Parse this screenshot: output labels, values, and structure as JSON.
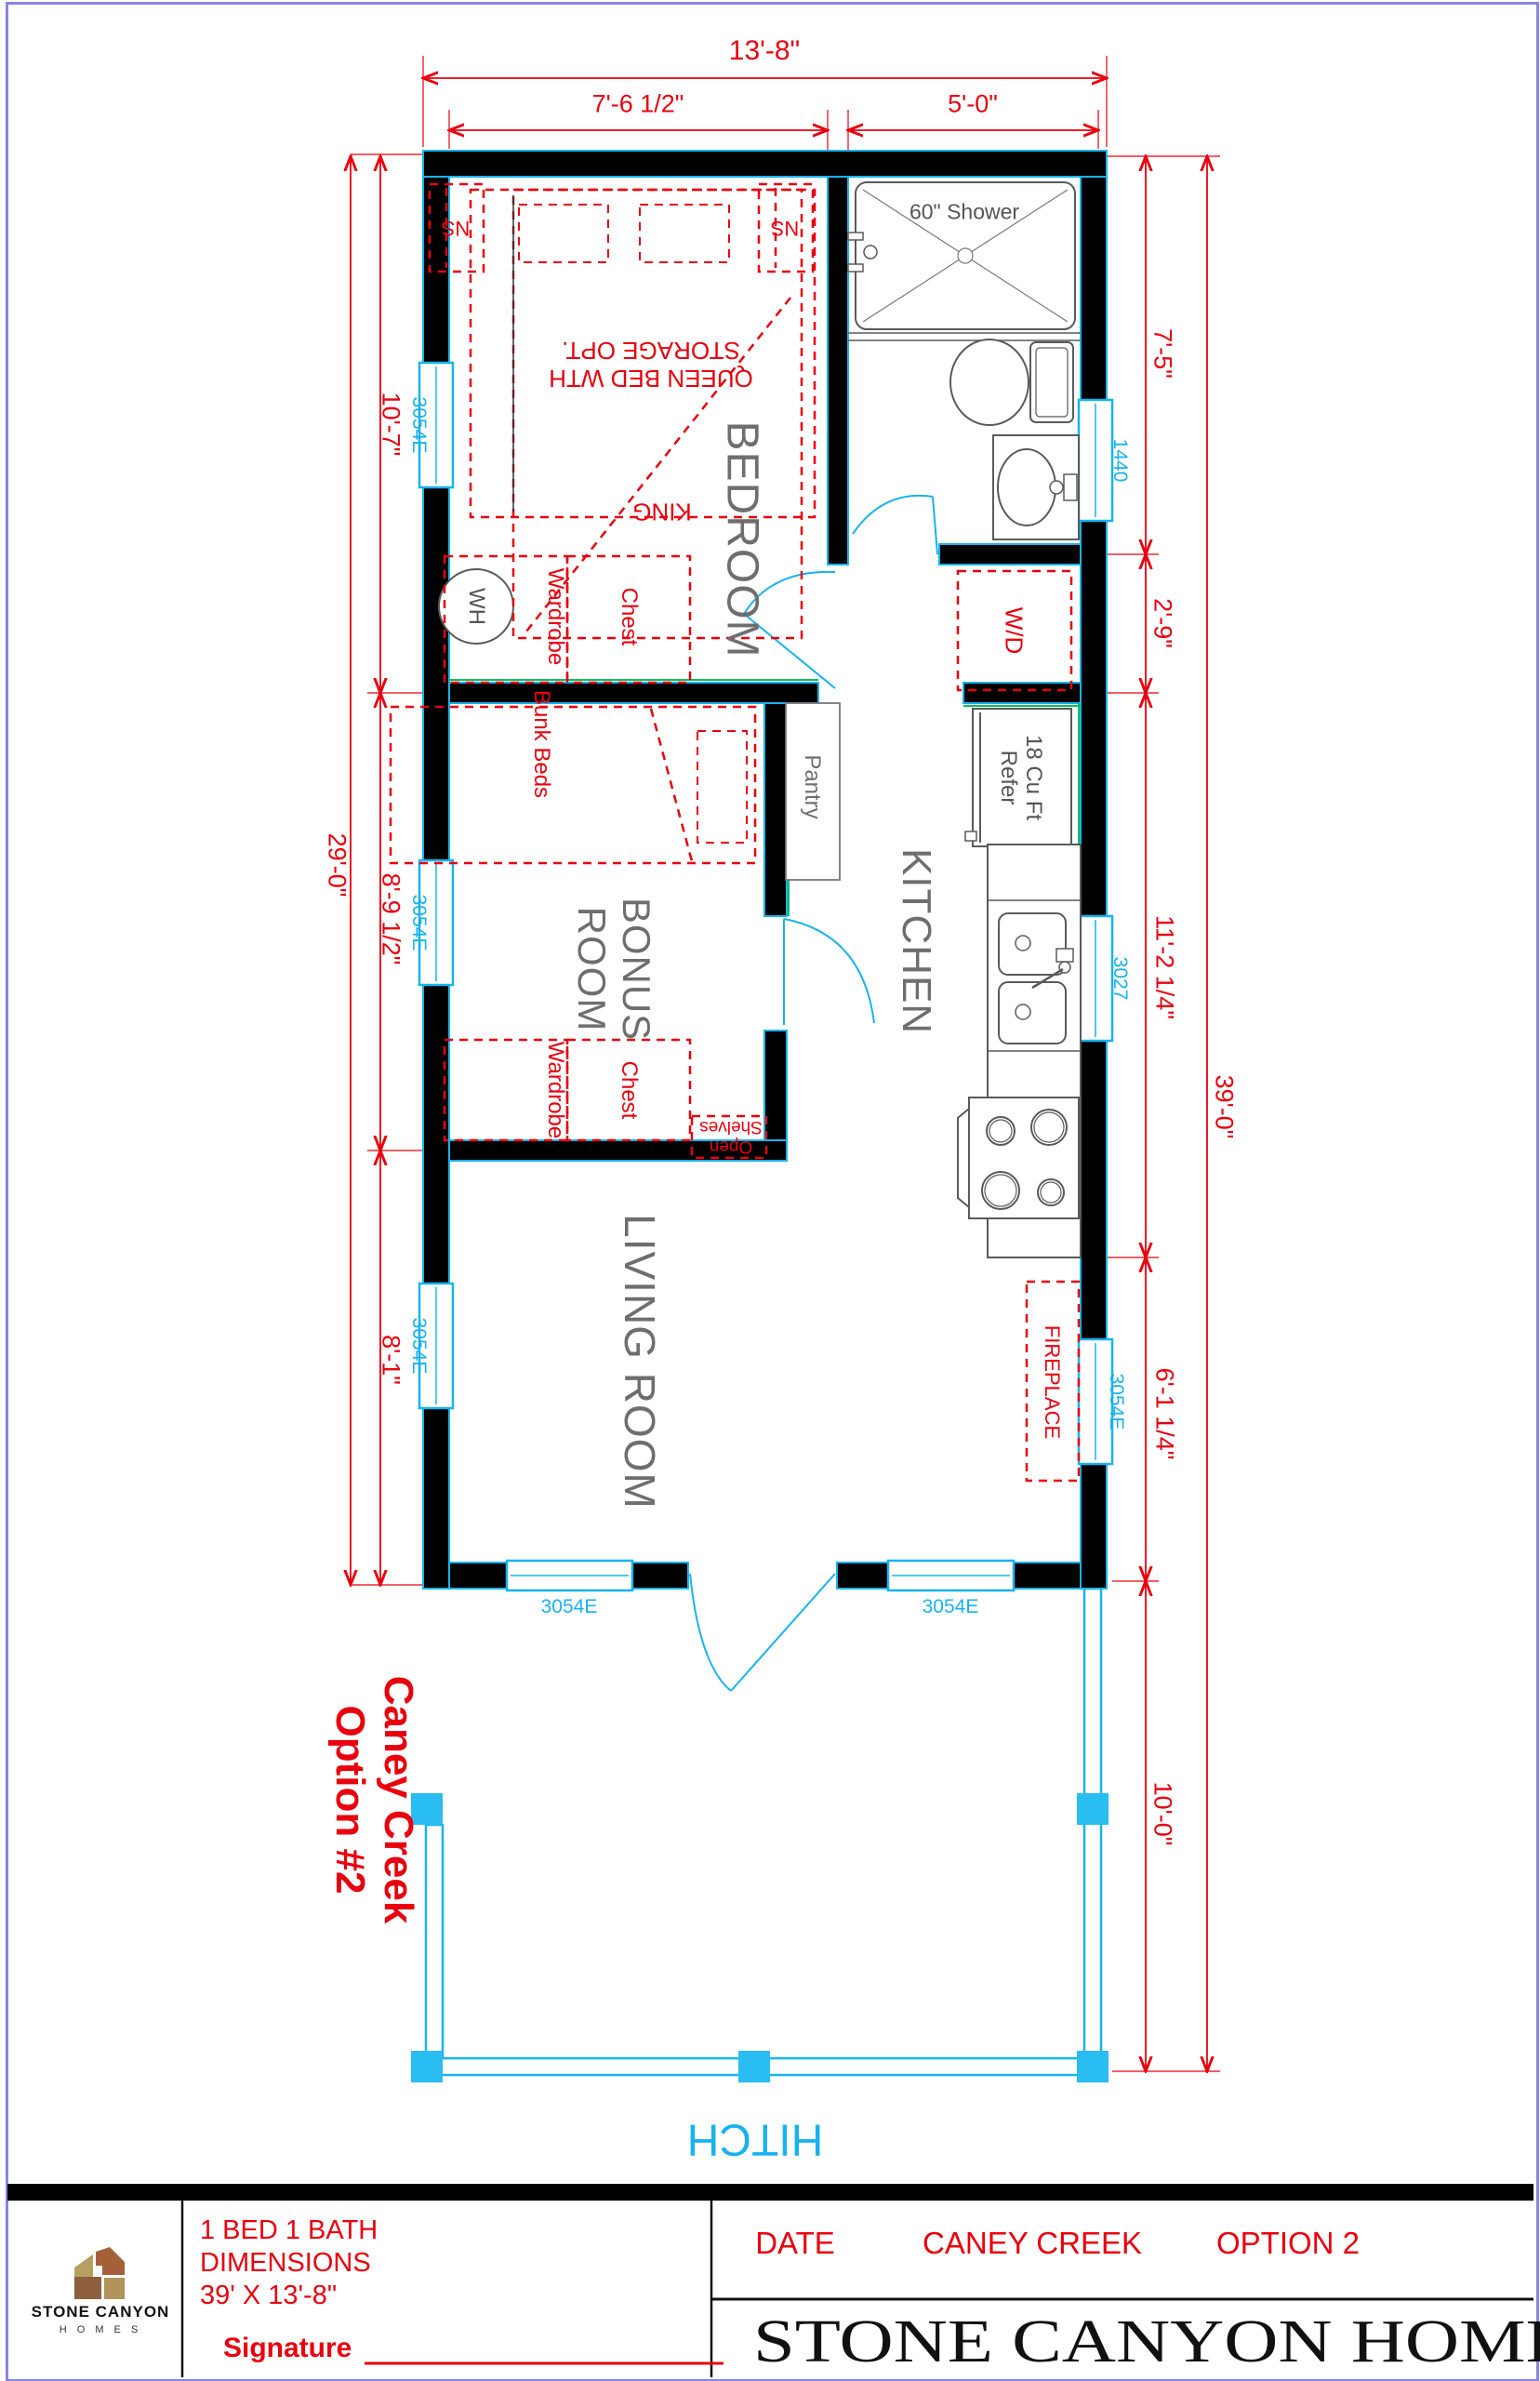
{
  "colors": {
    "red": "#e8000e",
    "cyan": "#17b3ef",
    "green": "#00c060",
    "wall": "#000000",
    "fixture_gray": "#5a5a5a",
    "label_gray": "#6e6e6e",
    "frame_blue": "#8585e8",
    "logo_tan": "#b5a061",
    "logo_brown": "#a5603a"
  },
  "plan": {
    "rooms": {
      "bedroom": "BEDROOM",
      "kitchen": "KITCHEN",
      "bonus1": "BONUS",
      "bonus2": "ROOM",
      "living": "LIVING ROOM"
    },
    "fixtures": {
      "shower": "60\" Shower",
      "wh": "WH",
      "wd": "W/D",
      "pantry": "Pantry",
      "refer1": "18 Cu Ft",
      "refer2": "Refer",
      "hitch": "HITCH"
    },
    "furniture": {
      "ns": "NS",
      "wardrobe": "Wardrobe",
      "chest": "Chest",
      "king": "KING",
      "queen1": "QUEEN BED WTH",
      "queen2": "STORAGE OPT.",
      "bunk": "Bunk Beds",
      "shelves1": "Open",
      "shelves2": "Shelves",
      "fireplace": "FIREPLACE"
    },
    "windows": {
      "w3054e": "3054E",
      "w1440": "1440",
      "w3027": "3027"
    },
    "dims": {
      "w_total": "13'-8\"",
      "w_bed": "7'-6 1/2\"",
      "w_bath": "5'-0\"",
      "h_bath": "7'-5\"",
      "h_wd": "2'-9\"",
      "h_kitchen": "11'-2 1/4\"",
      "h_fire": "6'-1 1/4\"",
      "h_total": "39'-0\"",
      "h_deck": "10'-0\"",
      "h_unit": "29'-0\"",
      "h_bed": "10'-7\"",
      "h_bonus": "8'-9 1/2\"",
      "h_living": "8'-1\""
    },
    "annotation": {
      "line1": "Caney Creek",
      "line2": "Option #2"
    }
  },
  "titleblock": {
    "logo1": "STONE CANYON",
    "logo2": "H O M E S",
    "desc1": "1 BED 1 BATH",
    "desc2": "DIMENSIONS",
    "desc3": "39' X 13'-8\"",
    "signature": "Signature",
    "date": "DATE",
    "project": "CANEY CREEK",
    "option": "OPTION 2",
    "company": "STONE CANYON HOMES"
  }
}
